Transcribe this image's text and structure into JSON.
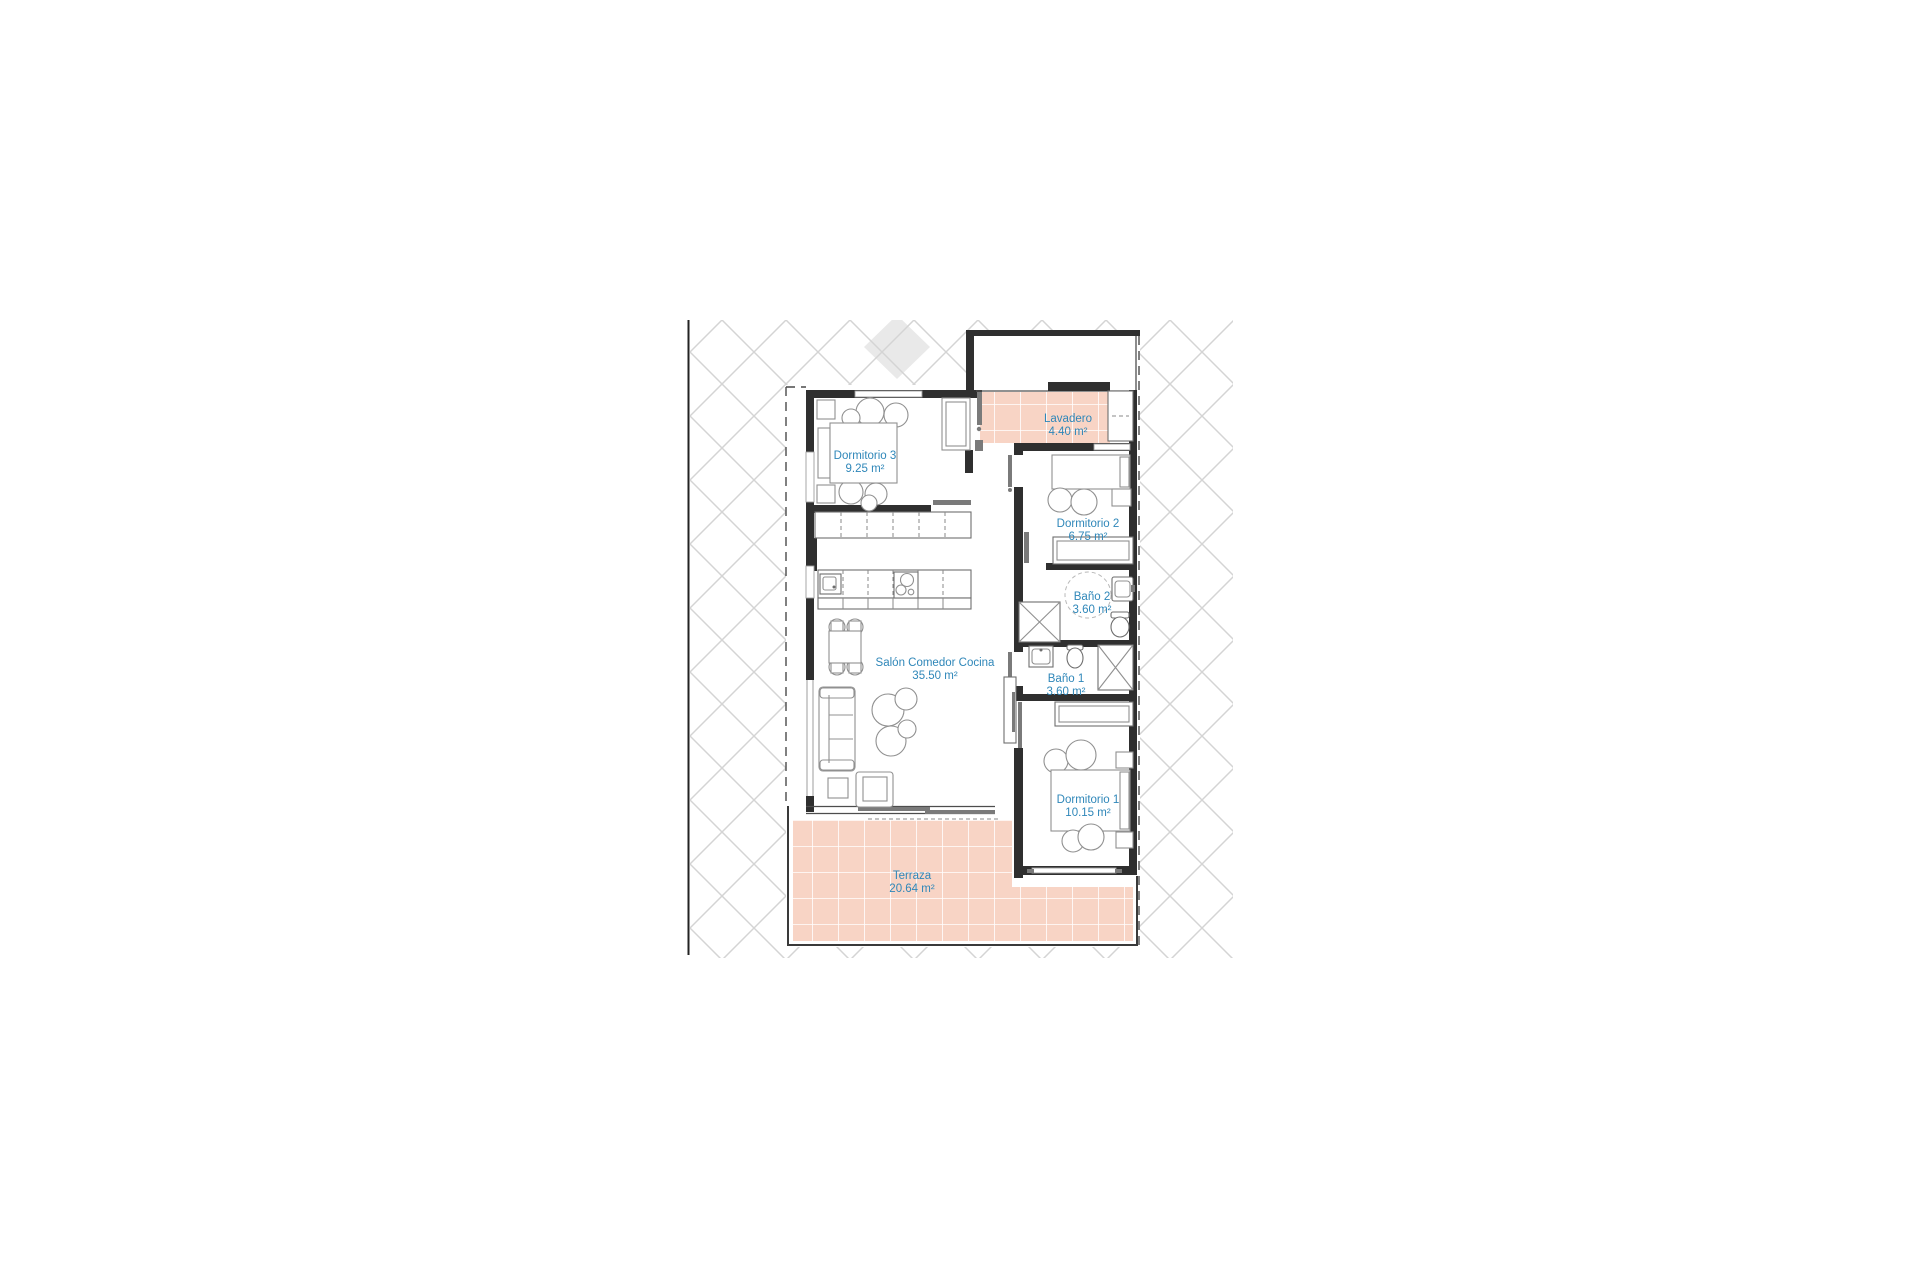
{
  "document": {
    "type": "apartment-floor-plan",
    "background": "#ffffff"
  },
  "colors": {
    "room_label_text": "#2f87b9",
    "tile_fill": "#f8d4c5",
    "tile_grid": "#ffffff",
    "hatch_line": "#d4d4d4",
    "hatch_cell_fill": "#e9e9e9",
    "wall": "#2f2f2f",
    "furniture_line": "#909090",
    "door_leaf": "#7a7a7a",
    "boundary_dash": "#4a4a4a"
  },
  "rooms": [
    {
      "id": "dormitorio3",
      "name": "Dormitorio 3",
      "area": "9.25 m²"
    },
    {
      "id": "lavadero",
      "name": "Lavadero",
      "area": "4.40 m²"
    },
    {
      "id": "dormitorio2",
      "name": "Dormitorio 2",
      "area": "6.75 m²"
    },
    {
      "id": "bano2",
      "name": "Baño 2",
      "area": "3.60 m²"
    },
    {
      "id": "salon",
      "name": "Salón Comedor Cocina",
      "area": "35.50 m²"
    },
    {
      "id": "bano1",
      "name": "Baño 1",
      "area": "3.60 m²"
    },
    {
      "id": "dormitorio1",
      "name": "Dormitorio 1",
      "area": "10.15 m²"
    },
    {
      "id": "terraza",
      "name": "Terraza",
      "area": "20.64 m²"
    }
  ]
}
